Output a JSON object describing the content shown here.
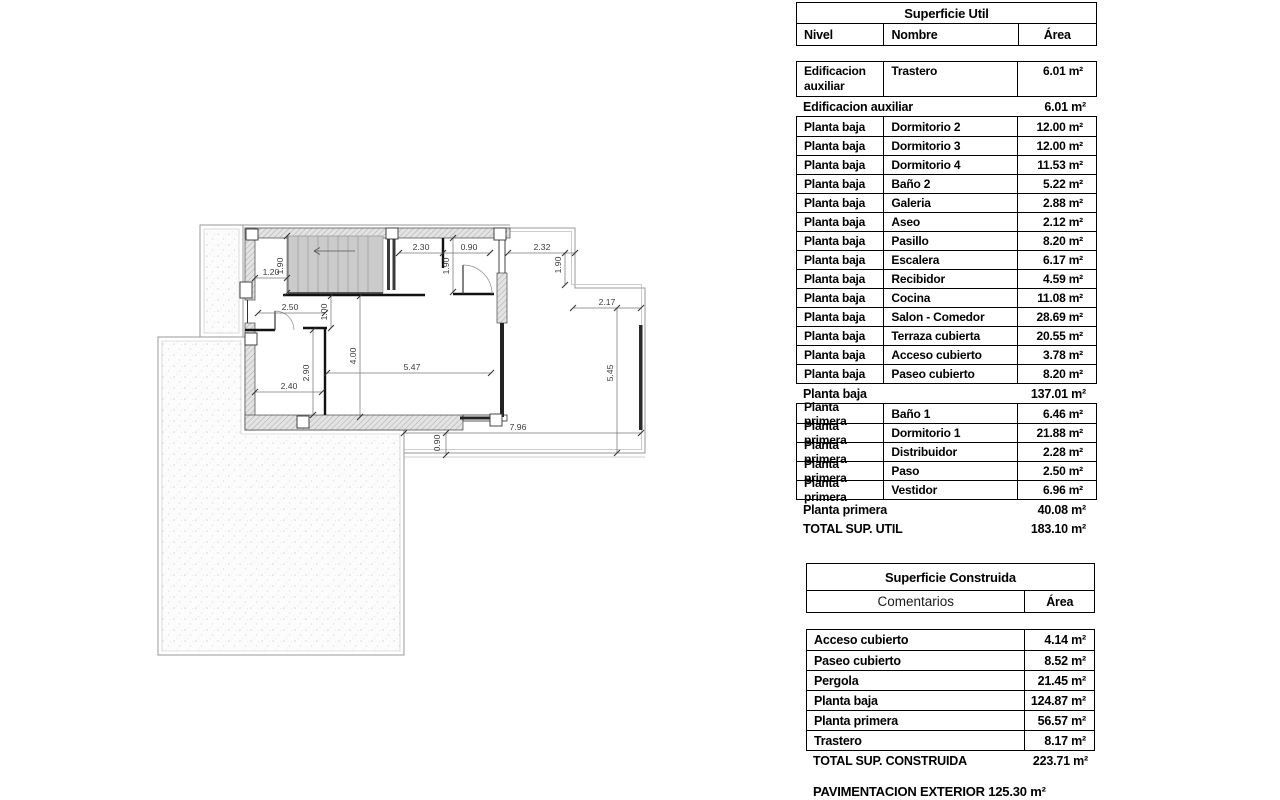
{
  "plan": {
    "dims": [
      "2.30",
      "0.90",
      "2.32",
      "1.20",
      "1.90",
      "1.90",
      "1.90",
      "2.17",
      "2.50",
      "1.00",
      "4.00",
      "5.47",
      "2.90",
      "2.40",
      "5.45",
      "7.96",
      "0.90"
    ]
  },
  "su": {
    "title": "Superficie Util",
    "col_nivel": "Nivel",
    "col_nombre": "Nombre",
    "col_area": "Área",
    "nivel_aux": "Edificacion auxiliar",
    "nivel_pb": "Planta baja",
    "nivel_pp": "Planta primera",
    "r0": {
      "nombre": "Trastero",
      "area": "6.01 m²"
    },
    "s0": {
      "label": "Edificacion auxiliar",
      "area": "6.01 m²"
    },
    "pb": [
      [
        "Dormitorio 2",
        "12.00 m²"
      ],
      [
        "Dormitorio 3",
        "12.00 m²"
      ],
      [
        "Dormitorio 4",
        "11.53 m²"
      ],
      [
        "Baño 2",
        "5.22 m²"
      ],
      [
        "Galeria",
        "2.88 m²"
      ],
      [
        "Aseo",
        "2.12 m²"
      ],
      [
        "Pasillo",
        "8.20 m²"
      ],
      [
        "Escalera",
        "6.17 m²"
      ],
      [
        "Recibidor",
        "4.59 m²"
      ],
      [
        "Cocina",
        "11.08 m²"
      ],
      [
        "Salon - Comedor",
        "28.69 m²"
      ],
      [
        "Terraza cubierta",
        "20.55 m²"
      ],
      [
        "Acceso cubierto",
        "3.78 m²"
      ],
      [
        "Paseo cubierto",
        "8.20 m²"
      ]
    ],
    "s1": {
      "label": "Planta baja",
      "area": "137.01 m²"
    },
    "pp": [
      [
        "Baño 1",
        "6.46 m²"
      ],
      [
        "Dormitorio 1",
        "21.88 m²"
      ],
      [
        "Distribuidor",
        "2.28 m²"
      ],
      [
        "Paso",
        "2.50 m²"
      ],
      [
        "Vestidor",
        "6.96 m²"
      ]
    ],
    "s2": {
      "label": "Planta primera",
      "area": "40.08 m²"
    },
    "total": {
      "label": "TOTAL SUP. UTIL",
      "area": "183.10 m²"
    }
  },
  "sc": {
    "title": "Superficie Construida",
    "col_comentarios": "Comentarios",
    "col_area": "Área",
    "rows": [
      [
        "Acceso cubierto",
        "4.14 m²"
      ],
      [
        "Paseo cubierto",
        "8.52 m²"
      ],
      [
        "Pergola",
        "21.45 m²"
      ],
      [
        "Planta baja",
        "124.87 m²"
      ],
      [
        "Planta primera",
        "56.57 m²"
      ],
      [
        "Trastero",
        "8.17 m²"
      ]
    ],
    "total": {
      "label": "TOTAL SUP. CONSTRUIDA",
      "area": "223.71 m²"
    }
  },
  "footer": {
    "pavimentacion": "PAVIMENTACION EXTERIOR 125.30 m²"
  }
}
